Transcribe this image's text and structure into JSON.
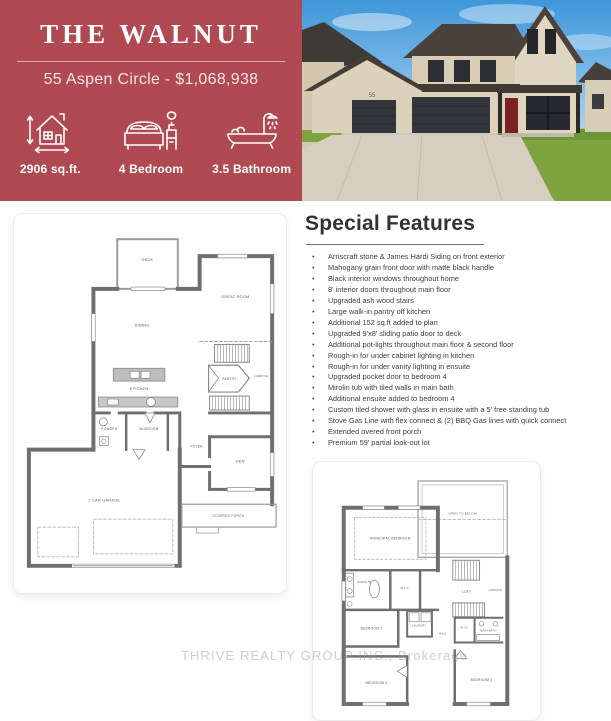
{
  "header": {
    "title": "THE WALNUT",
    "subtitle": "55 Aspen Circle - $1,068,938",
    "accent_color": "#b04a52",
    "stats": [
      {
        "icon": "house-area-icon",
        "label": "2906 sq.ft."
      },
      {
        "icon": "bed-icon",
        "label": "4 Bedroom"
      },
      {
        "icon": "bathtub-icon",
        "label": "3.5 Bathroom"
      }
    ]
  },
  "photo": {
    "description": "front exterior photo of two-storey stone house with double and single garage",
    "house_number": "55"
  },
  "features": {
    "heading": "Special Features",
    "items": [
      "Arriscraft stone & James Hardi Siding on front exterior",
      "Mahogany grain front door with matte black handle",
      "Black interior windows throughout home",
      "8' interior doors throughout main floor",
      "Upgraded ash wood stairs",
      "Large walk-in pantry off kitchen",
      "Additional 152 sq.ft added to plan",
      "Upgraded 9'x8' sliding patio door to deck",
      "Additional pot-lights throughout main floor & second floor",
      "Rough-in for under cabinet lighting in kitchen",
      "Rough-in for under vanity lighting in ensuite",
      "Upgraded pocket door to bedroom 4",
      "Mirolin tub with tiled walls in main bath",
      "Additional ensuite added to bedroom 4",
      "Custom tiled shower with glass in ensuite with a 5' free standing tub",
      "Stove Gas Line with flex connect & (2) BBQ Gas lines with quick connect",
      "Extended overed front porch",
      "Premium 59' partial look-out lot"
    ]
  },
  "floorplans": {
    "main": {
      "name": "main floor plan",
      "rooms": [
        "DECK",
        "GREAT ROOM",
        "DINING",
        "KITCHEN",
        "PANTRY",
        "LANDING",
        "POWDER",
        "MUDROOM",
        "FOYER",
        "DEN",
        "2 CAR GARAGE",
        "COVERED PORCH"
      ]
    },
    "second": {
      "name": "second floor plan",
      "rooms": [
        "PRINCIPAL BEDROOM",
        "OPEN TO BELOW",
        "ENSUITE",
        "W.I.C.",
        "LOFT",
        "LANDING",
        "BEDROOM 2",
        "LAUNDRY",
        "HALL",
        "MAIN BATH",
        "BEDROOM 3",
        "BEDROOM 4",
        "W.I.C."
      ]
    }
  },
  "watermark": "THRIVE REALTY GROUP INC., Brokerage"
}
